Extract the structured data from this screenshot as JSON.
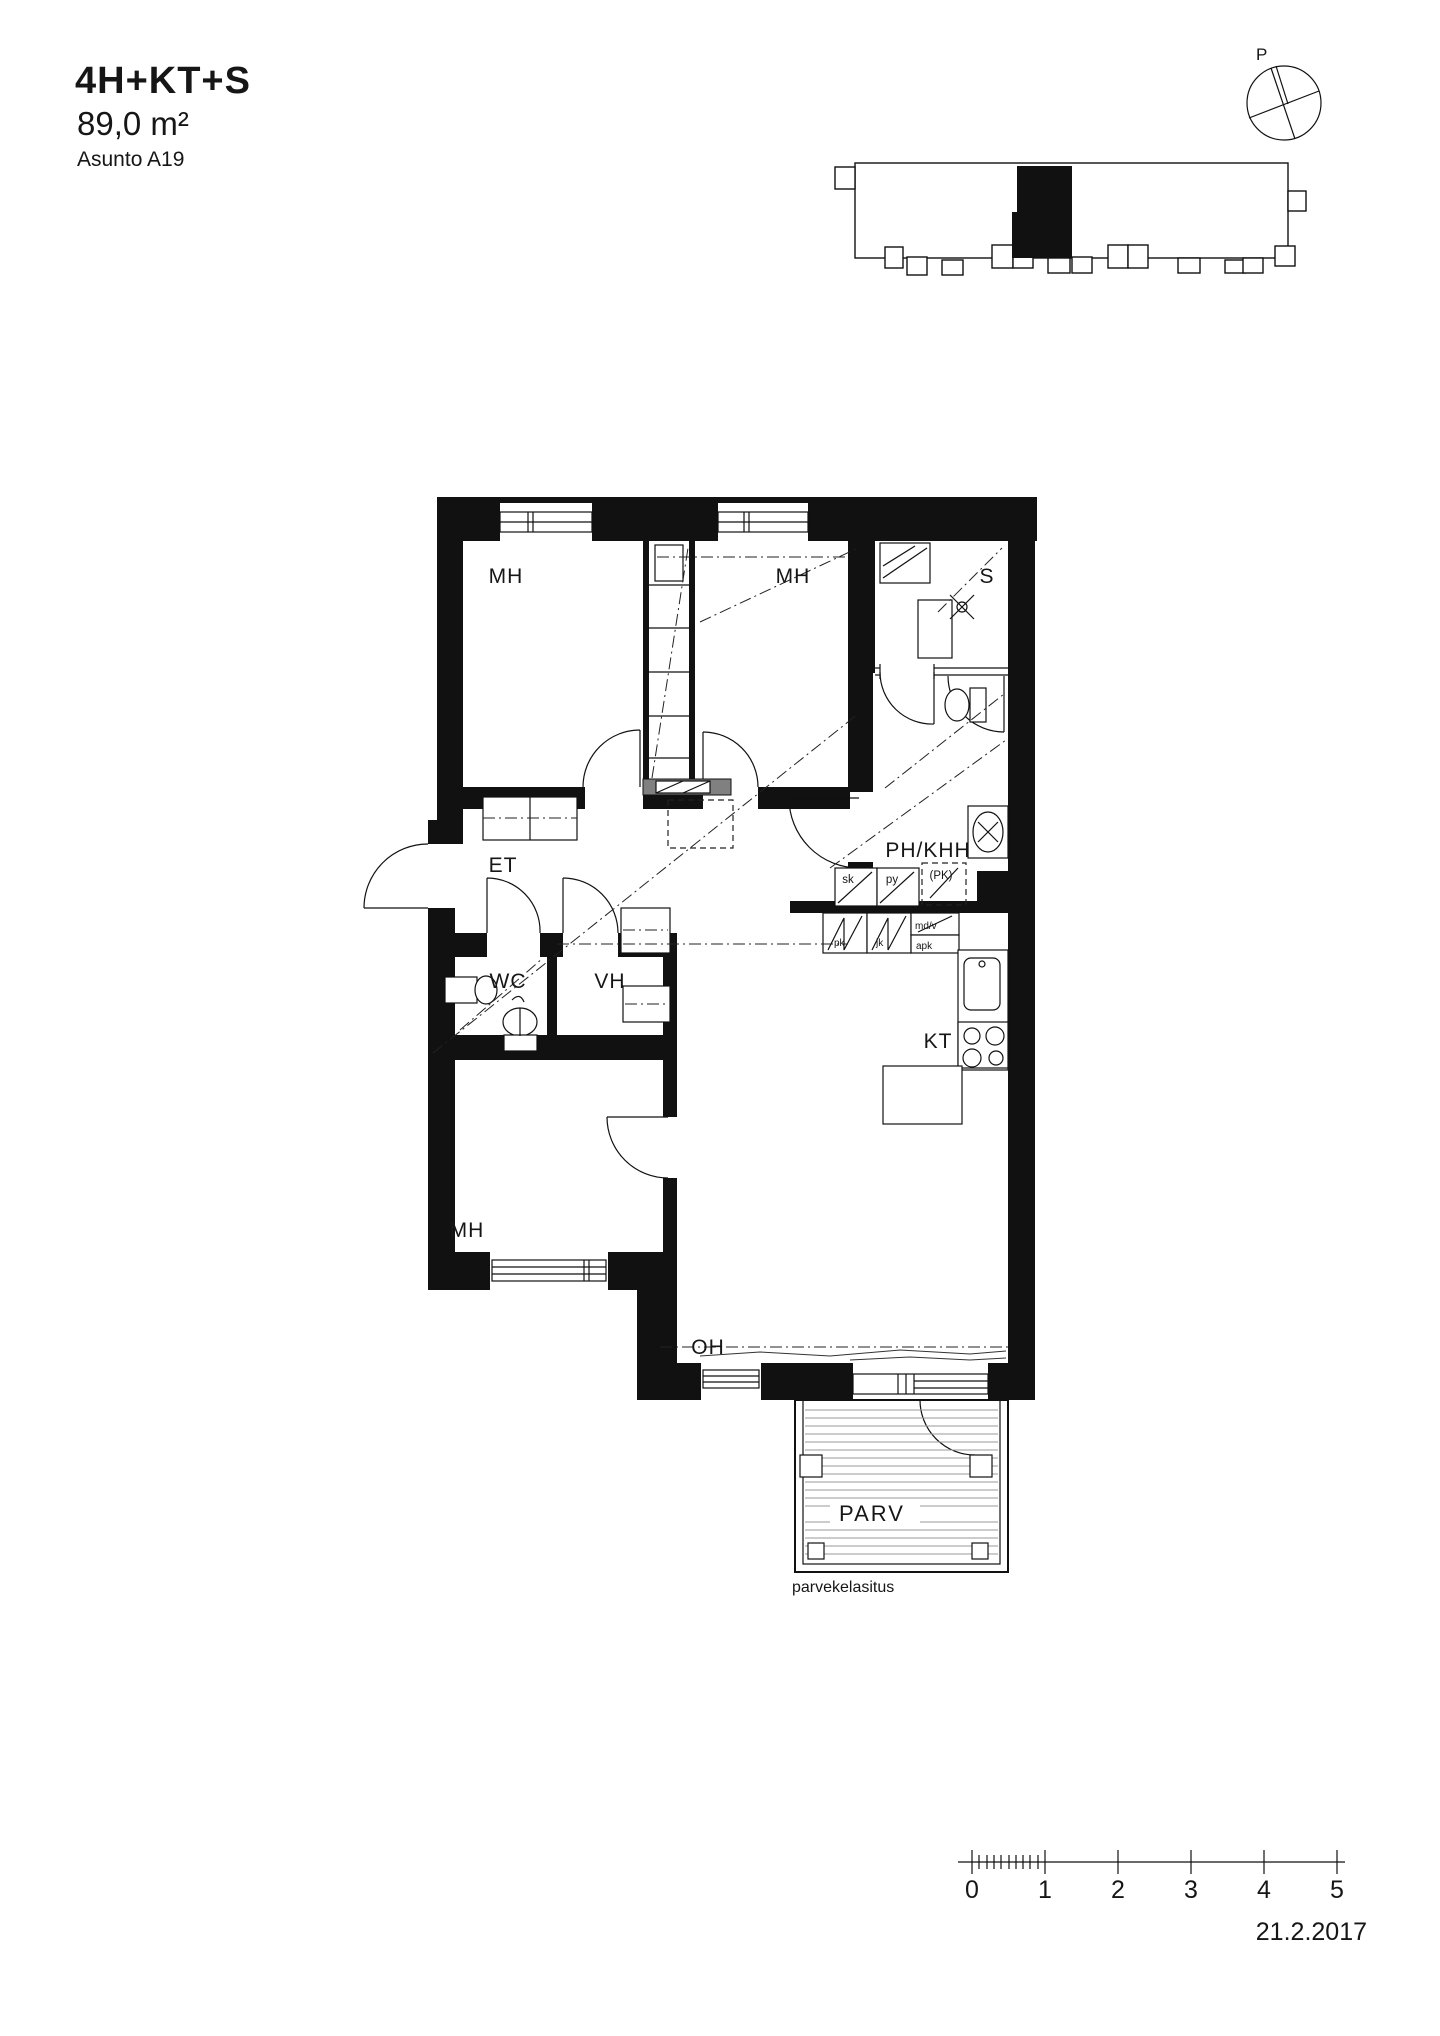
{
  "header": {
    "type_code": "4H+KT+S",
    "area": "89,0 m²",
    "apartment": "Asunto A19"
  },
  "compass": {
    "north_label": "P"
  },
  "rooms": {
    "mh1": "MH",
    "mh2": "MH",
    "sauna": "S",
    "ph_khh": "PH/KHH",
    "et": "ET",
    "wc": "WC",
    "vh": "VH",
    "kt": "KT",
    "mh3": "MH",
    "oh": "OH",
    "parv": "PARV"
  },
  "appliances": {
    "sk": "sk",
    "py": "py",
    "pk_reserve": "(PK)",
    "pk": "pk",
    "jk": "jk",
    "md_v": "md/v",
    "apk": "apk"
  },
  "annotations": {
    "balcony_glazing": "parvekelasitus"
  },
  "scale_bar": {
    "ticks": [
      "0",
      "1",
      "2",
      "3",
      "4",
      "5"
    ]
  },
  "footer": {
    "date": "21.2.2017"
  },
  "colors": {
    "line": "#111111",
    "wall": "#111111",
    "gray_block": "#808080",
    "decking": "#9a9a9a"
  }
}
